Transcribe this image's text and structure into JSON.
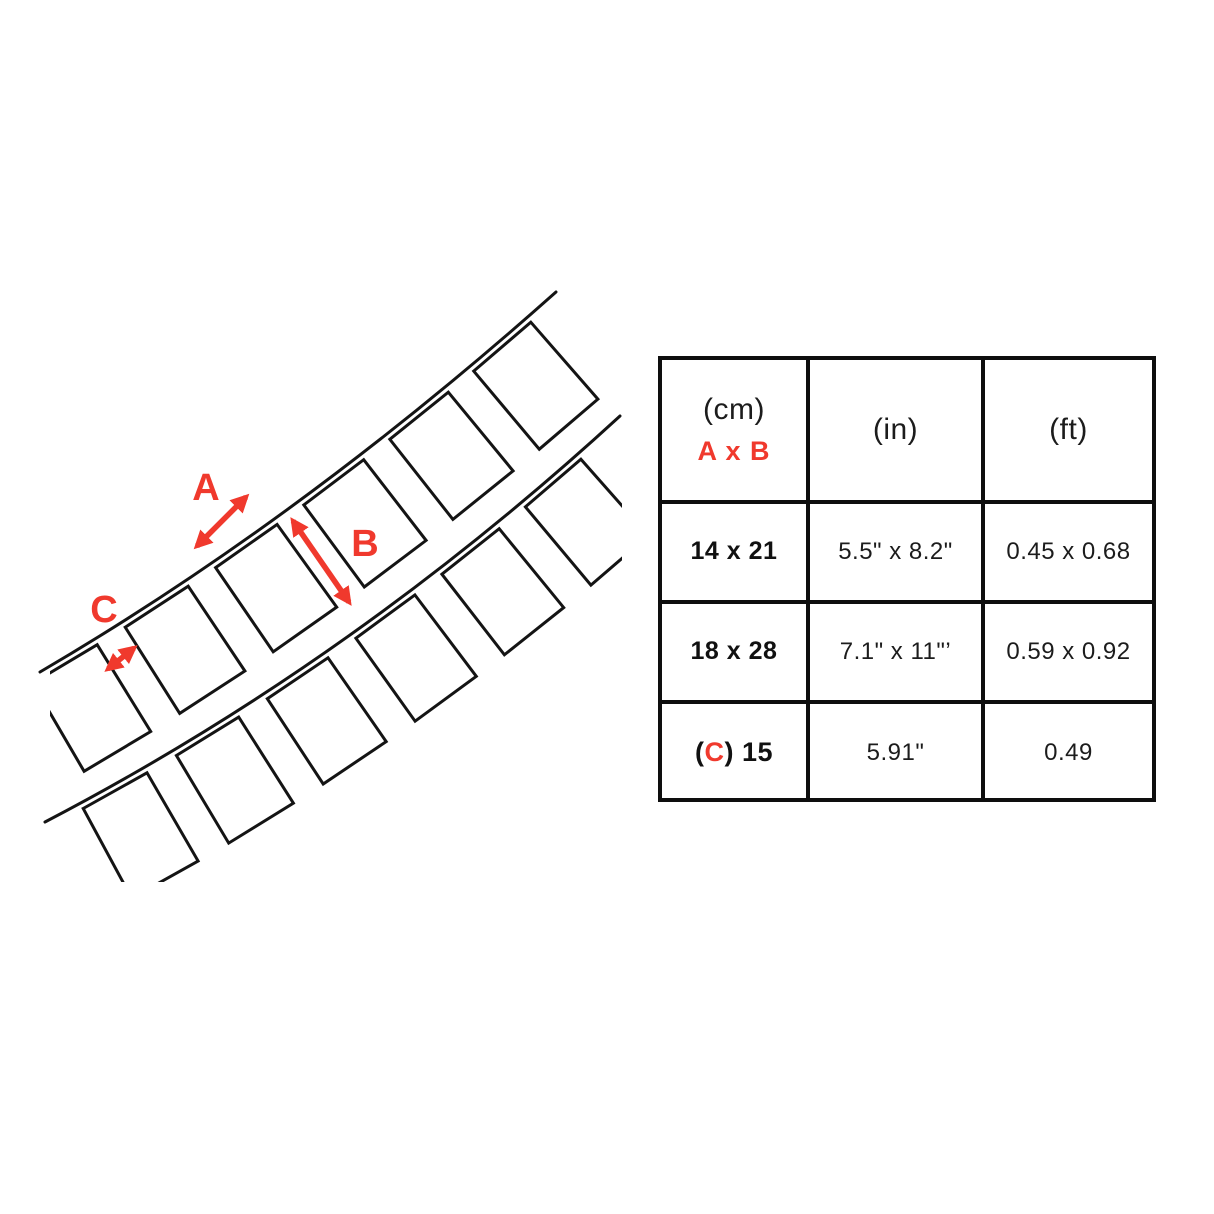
{
  "diagram": {
    "label_a": "A",
    "label_b": "B",
    "label_c": "C",
    "accent_color": "#f0392d",
    "line_color": "#141414"
  },
  "table": {
    "header": {
      "cm": "(cm)",
      "axb": "A x B",
      "in": "(in)",
      "ft": "(ft)"
    },
    "rows": [
      {
        "cm": "14 x 21",
        "inch": "5.5\" x 8.2\"",
        "ft": "0.45 x 0.68"
      },
      {
        "cm": "18 x 28",
        "inch": "7.1\" x 11\"’",
        "ft": "0.59 x 0.92"
      },
      {
        "cm_open": "(",
        "cm_c": "C",
        "cm_rest": ") 15",
        "inch": "5.91\"",
        "ft": "0.49"
      }
    ]
  }
}
